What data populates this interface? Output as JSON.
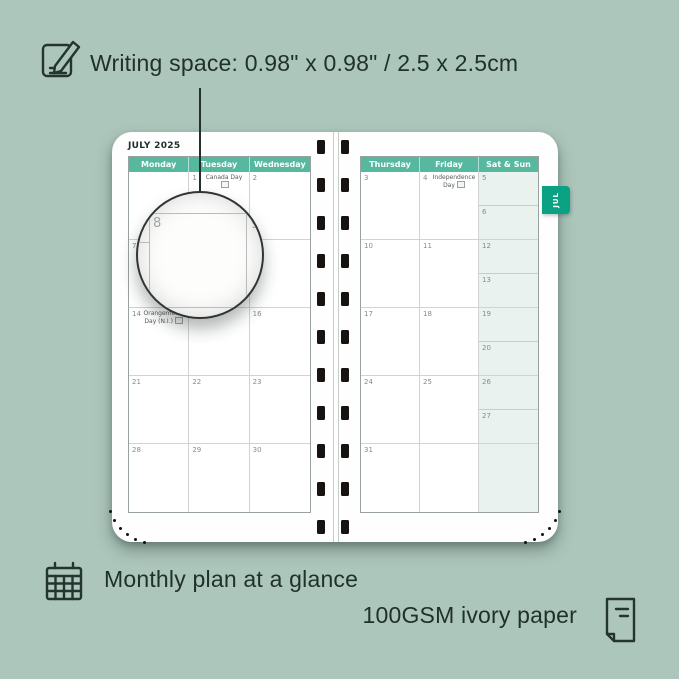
{
  "colors": {
    "background": "#adc6bb",
    "header_green": "#57b8a0",
    "tab_green": "#0ba183",
    "weekend_cell": "#e9f2ee",
    "annotation_text": "#20312b"
  },
  "annotations": {
    "writing_space": "Writing space: 0.98\" x 0.98\" / 2.5 x 2.5cm",
    "monthly_plan": "Monthly plan at a glance",
    "paper": "100GSM ivory paper"
  },
  "planner": {
    "month_title": "JULY 2025",
    "tab_label": "JUL",
    "lens": {
      "magnified_day": "8",
      "adjacent_day": "9"
    },
    "left_page": {
      "headers": [
        "Monday",
        "Tuesday",
        "Wednesday"
      ],
      "weeks": [
        [
          {},
          {
            "day": "1",
            "event": "Canada Day",
            "holiday_icon": true
          },
          {
            "day": "2"
          }
        ],
        [
          {
            "day": "7"
          },
          {
            "day": "8"
          },
          {
            "day": "9"
          }
        ],
        [
          {
            "day": "14",
            "event": "Orangemen's Day (N.I.)",
            "holiday_icon": true
          },
          {
            "day": "15"
          },
          {
            "day": "16"
          }
        ],
        [
          {
            "day": "21"
          },
          {
            "day": "22"
          },
          {
            "day": "23"
          }
        ],
        [
          {
            "day": "28"
          },
          {
            "day": "29"
          },
          {
            "day": "30"
          }
        ]
      ]
    },
    "right_page": {
      "headers": [
        "Thursday",
        "Friday",
        "Sat & Sun"
      ],
      "weeks": [
        [
          {
            "day": "3"
          },
          {
            "day": "4",
            "event": "Independence Day",
            "holiday_icon": true
          },
          {
            "weekend": true,
            "sat": {
              "day": "5"
            },
            "sun": {
              "day": "6"
            }
          }
        ],
        [
          {
            "day": "10"
          },
          {
            "day": "11"
          },
          {
            "weekend": true,
            "sat": {
              "day": "12"
            },
            "sun": {
              "day": "13"
            }
          }
        ],
        [
          {
            "day": "17"
          },
          {
            "day": "18"
          },
          {
            "weekend": true,
            "sat": {
              "day": "19"
            },
            "sun": {
              "day": "20"
            }
          }
        ],
        [
          {
            "day": "24"
          },
          {
            "day": "25"
          },
          {
            "weekend": true,
            "sat": {
              "day": "26"
            },
            "sun": {
              "day": "27"
            }
          }
        ],
        [
          {
            "day": "31"
          },
          {},
          {
            "weekend": true,
            "full": true
          }
        ]
      ]
    }
  }
}
